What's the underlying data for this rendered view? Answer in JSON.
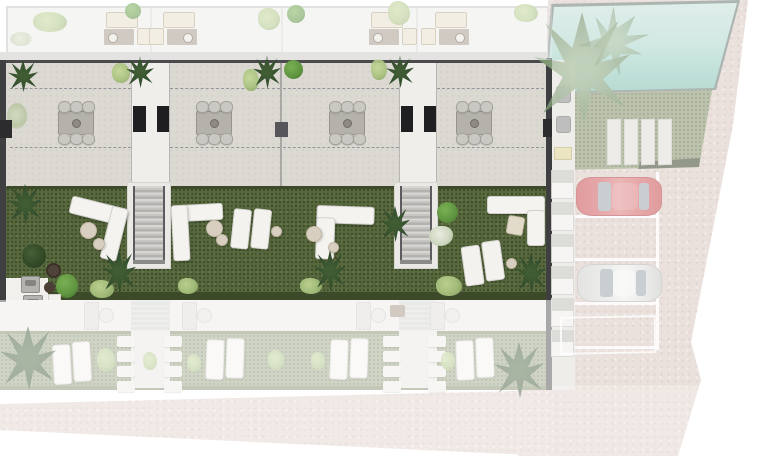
{
  "scene": {
    "description": "Top-down 3D architectural site plan of four terraced garden apartments with roof terraces, private gardens, communal swimming pool, storage sheds and parking; the central garden level is shown in full colour while the roof level, ground level and surroundings are faded white.",
    "highlighted_level": "garden level"
  },
  "colors": {
    "background": "#ffffff",
    "roof": "#ecebe8",
    "terrace": "#dcd9d3",
    "grass": "#57683d",
    "grass_faded": "#96a17e",
    "hedge": "#3c4a2a",
    "pool_light": "#cfe5df",
    "pool_deep": "#8cc4b6",
    "pool_rim": "#7d8b87",
    "pavement": "#decfc8",
    "wall_dark": "#3f3f42",
    "door_black": "#1f1f22",
    "furniture_white": "#f4f3ef",
    "furniture_beige": "#e7dfcc",
    "rug_brown": "#a89a8a",
    "pouf_beige": "#d9cfc0",
    "car_red": "#d9787a",
    "car_white": "#e4e4e2",
    "window_glass": "#aab3b8",
    "slab": "#e4e2dd",
    "stone": "#edebe7",
    "palm_green": "#2f4a2c",
    "tree_green": "#5f9440",
    "tuft_light": "#a8c27e"
  },
  "inventory": {
    "residential_units": 4,
    "roof_terrace_lounge_sets": 4,
    "outdoor_dining_sets": 4,
    "garden_corner_sofas": 4,
    "garden_staircases": 2,
    "sun_lounger_pairs": 6,
    "swimming_pools": 1,
    "parking_spaces": 4,
    "parked_cars": 2,
    "car_colors": [
      "red",
      "white"
    ],
    "storage_sheds": 6,
    "lawn_paving_slabs": 4,
    "entrance_doors": 4
  }
}
